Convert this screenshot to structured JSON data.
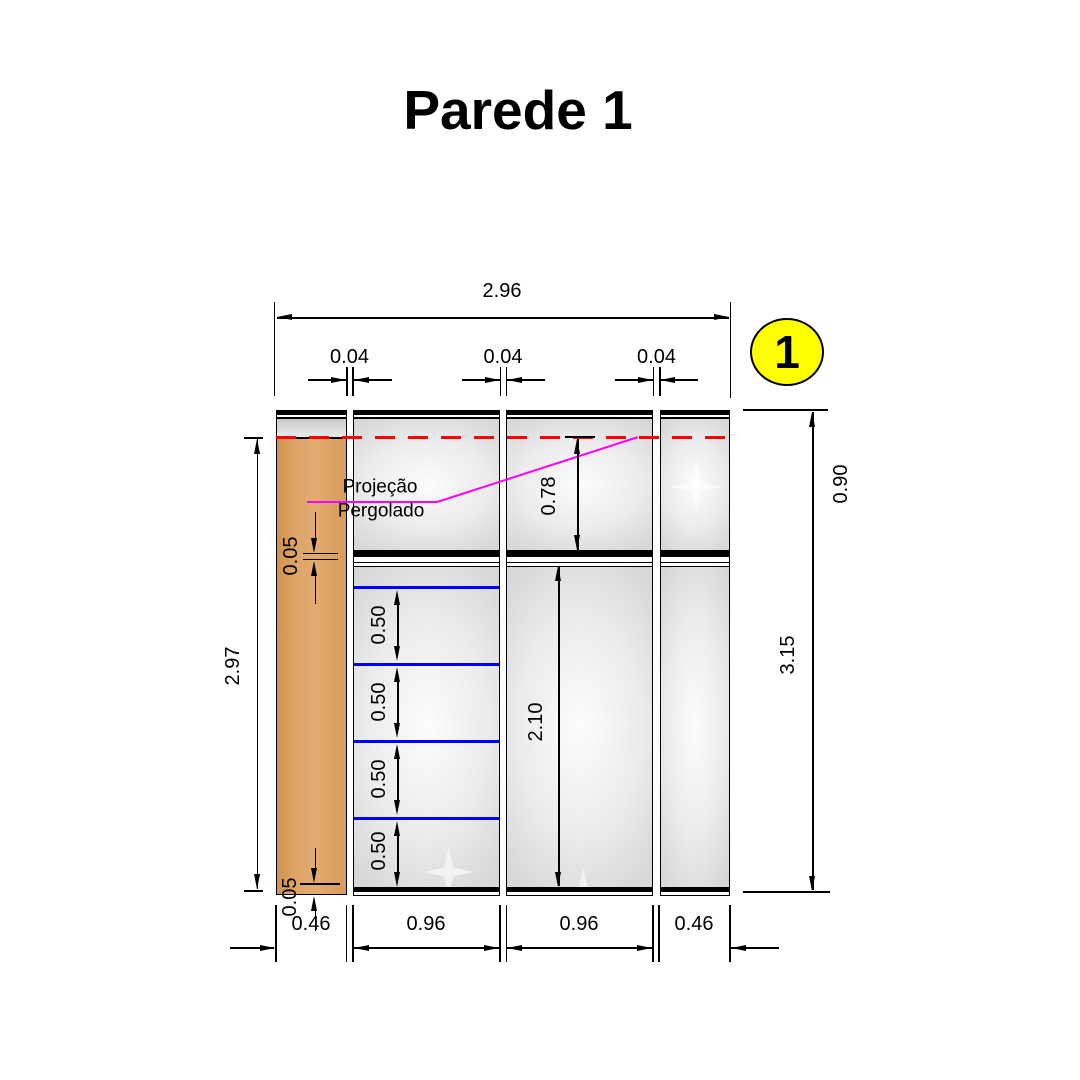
{
  "title": "Parede 1",
  "badge": {
    "number": "1"
  },
  "annotation": {
    "line1": "Projeção",
    "line2": "Pergolado"
  },
  "dims": {
    "total_width": "2.96",
    "panel_gaps": [
      "0.04",
      "0.04",
      "0.04"
    ],
    "left_height": "2.97",
    "top_section_height": "0.90",
    "total_height": "3.15",
    "upper_opening": "0.78",
    "lower_opening": "2.10",
    "shelf_spacings": [
      "0.50",
      "0.50",
      "0.50",
      "0.50"
    ],
    "divider_thickness": "0.05",
    "base_height": "0.05",
    "bottom_widths": [
      "0.46",
      "0.96",
      "0.96",
      "0.46"
    ]
  },
  "colors": {
    "highlight_panel": "#DCA266",
    "shelf_line": "#0000FF",
    "projection_dash": "#FF0000",
    "pergola_line": "#FF00FF",
    "badge_fill": "#FFFF00",
    "line": "#000000"
  }
}
